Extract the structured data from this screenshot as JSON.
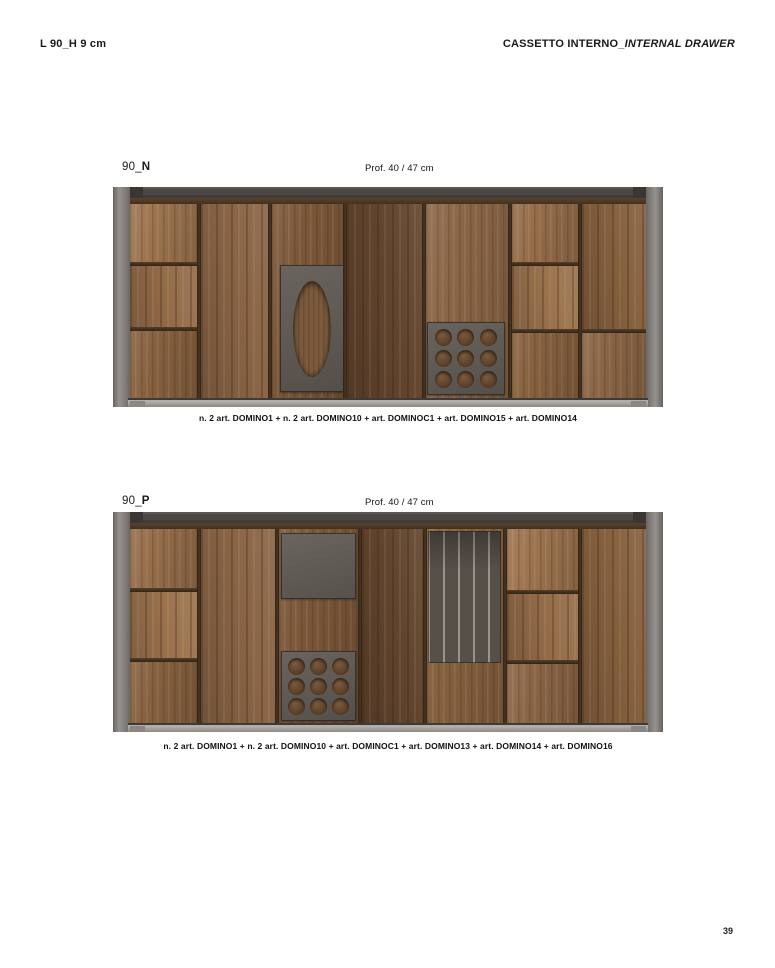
{
  "header": {
    "left": "L 90_H 9 cm",
    "right_main": "CASSETTO INTERNO_",
    "right_italic": "INTERNAL DRAWER"
  },
  "figures": [
    {
      "label_prefix": "90_",
      "label_letter": "N",
      "depth_label": "Prof. 40 / 47 cm",
      "caption": "n. 2 art. DOMINO1 + n. 2 art. DOMINO10 + art. DOMINOC1 + art. DOMINO15 + art. DOMINO14"
    },
    {
      "label_prefix": "90_",
      "label_letter": "P",
      "depth_label": "Prof. 40 / 47 cm",
      "caption": "n. 2 art. DOMINO1 + n. 2 art. DOMINO10 + art. DOMINOC1 + art. DOMINO13 + art. DOMINO14 + art. DOMINO16"
    }
  ],
  "page_number": "39",
  "colors": {
    "wood_base": "#8a6546",
    "frame_gray": "#8f8b88",
    "frame_top": "#4b4744",
    "insert_gray": "#5d5853",
    "divider": "#3d2e1f"
  }
}
